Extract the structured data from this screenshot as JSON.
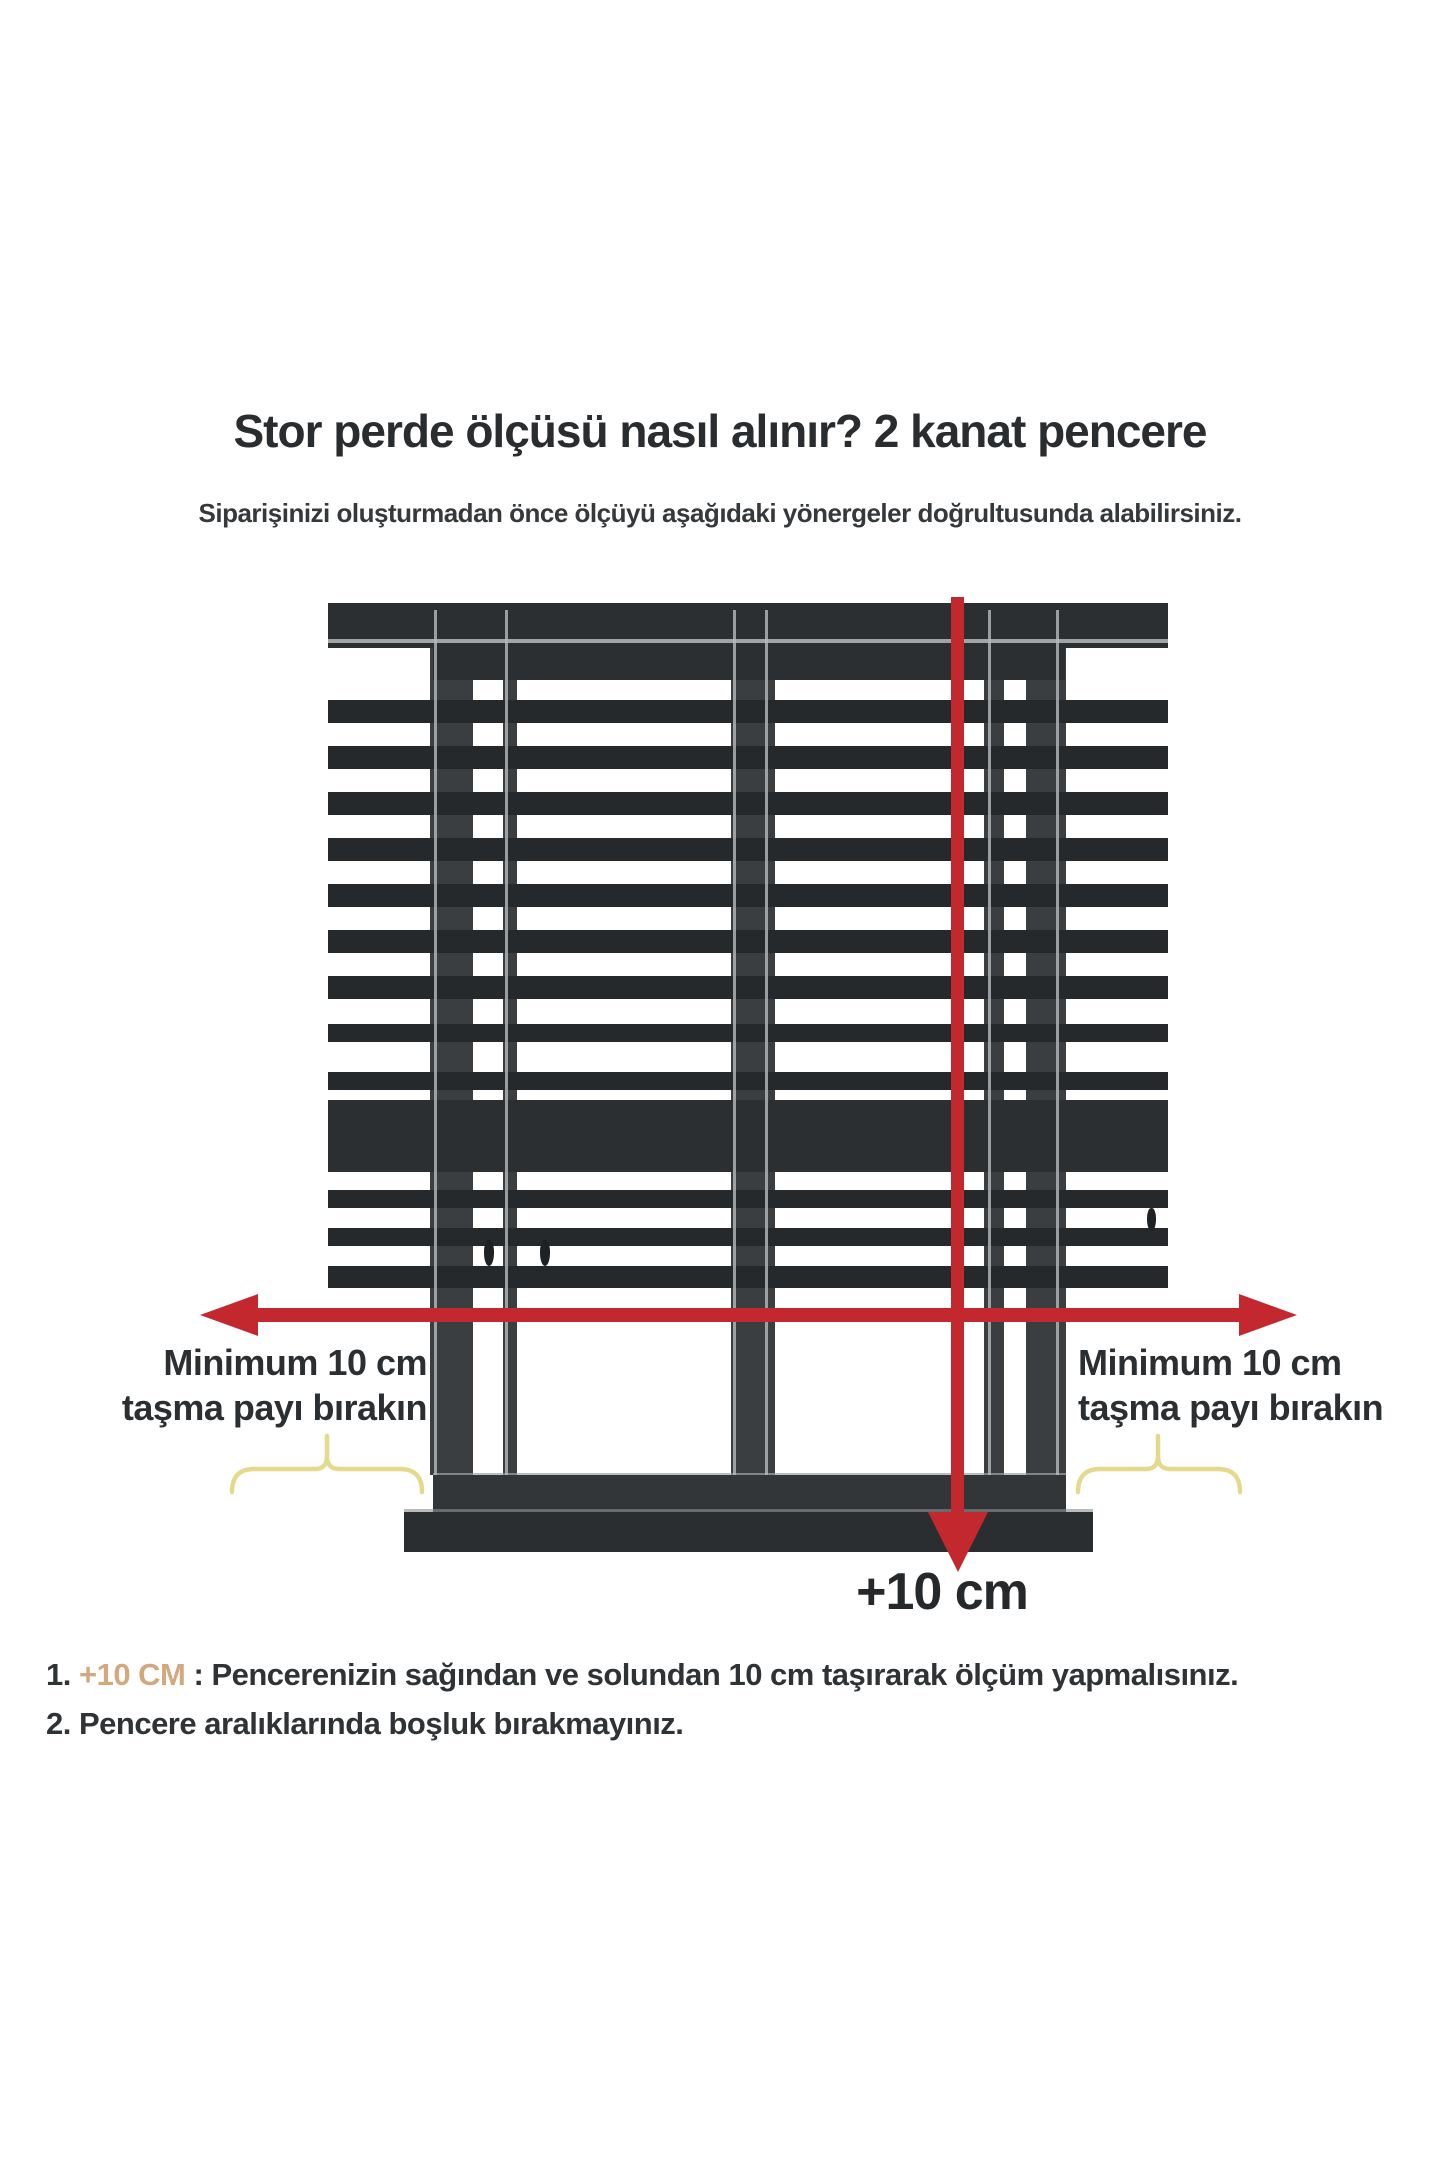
{
  "title": "Stor perde ölçüsü nasıl alınır? 2 kanat pencere",
  "subtitle": "Siparişinizi oluşturmadan önce ölçüyü aşağıdaki yönergeler doğrultusunda alabilirsiniz.",
  "diagram_labels": {
    "left": {
      "line1": "Minimum 10 cm",
      "line2": "taşma payı bırakın"
    },
    "right": {
      "line1": "Minimum 10 cm",
      "line2": "taşma payı bırakın"
    },
    "bottom_measure": "+10 cm"
  },
  "notes": [
    {
      "num": "1.",
      "highlight": " +10 CM",
      "text": " : Pencerenizin sağından ve solundan 10 cm taşırarak ölçüm yapmalısınız."
    },
    {
      "num": "2.",
      "highlight": "",
      "text": " Pencere aralıklarında boşluk bırakmayınız."
    }
  ],
  "colors": {
    "red": "#c2282e",
    "dark": "#2b2f31",
    "slat": "#26292b",
    "post": "#3a3e40",
    "stripe": "#b7babc",
    "brace": "#e5d98e",
    "note_highlight": "#d2a87c",
    "text": "#2c2f32"
  }
}
